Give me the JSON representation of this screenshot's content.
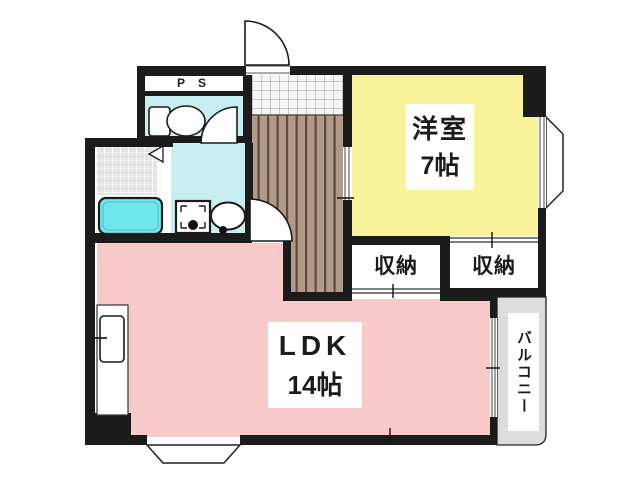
{
  "floor_plan": {
    "ps_label": "P S",
    "western_room": {
      "name": "洋室",
      "size": "7帖",
      "color": "#f8f39b"
    },
    "ldk": {
      "name": "LDK",
      "size": "14帖",
      "color": "#f8caca"
    },
    "storage_left": {
      "label": "収納"
    },
    "storage_right": {
      "label": "収納"
    },
    "balcony": {
      "label": "バルコニー",
      "color": "#dcdcdc"
    },
    "wet_area": {
      "room_color": "#c9eef1",
      "bathtub_color": "#6fe6eb"
    },
    "hallway": {
      "floor_color": "#b19a89",
      "stripe_color": "#5d4b3f"
    },
    "wall_color": "#1b1b1b",
    "fixtures": [
      "toilet",
      "bathtub",
      "washbasin",
      "washing-machine-pan",
      "kitchen-sink"
    ]
  }
}
